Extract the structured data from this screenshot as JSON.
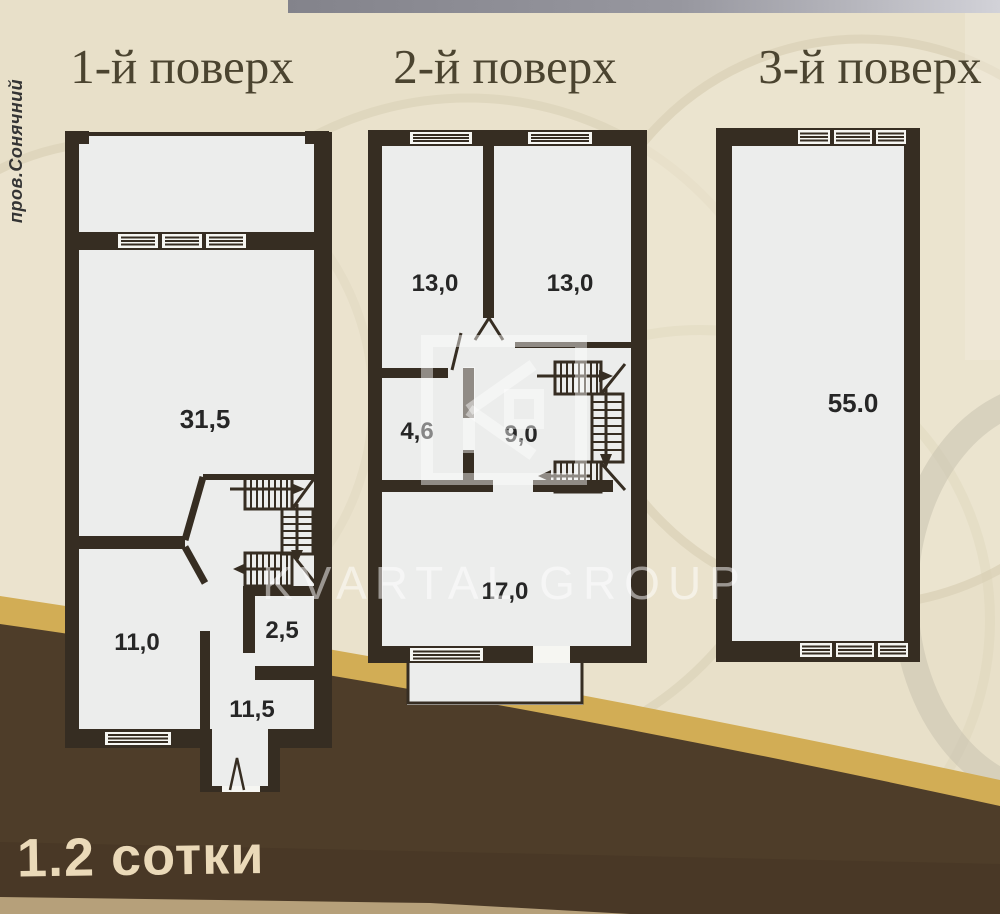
{
  "street_label": "пров.Сонячний",
  "floors": [
    {
      "title": "1-й поверх",
      "rooms": [
        {
          "area": "31,5"
        },
        {
          "area": "11,0"
        },
        {
          "area": "2,5"
        },
        {
          "area": "11,5"
        }
      ]
    },
    {
      "title": "2-й поверх",
      "rooms": [
        {
          "area": "13,0"
        },
        {
          "area": "13,0"
        },
        {
          "area": "4,6"
        },
        {
          "area": "9,0"
        },
        {
          "area": "17,0"
        }
      ]
    },
    {
      "title": "3-й поверх",
      "rooms": [
        {
          "area": "55.0"
        }
      ]
    }
  ],
  "watermark": {
    "text": "KVARTAL GROUP"
  },
  "footer": {
    "dash": "-",
    "area_text": "1.2 сотки"
  },
  "colors": {
    "background": "#e8e0c9",
    "wall": "#362d22",
    "floor_fill": "#ecedec",
    "title_text": "#4b4430",
    "wave_brown": "#4e3d29",
    "gold_band": "#d2ad55",
    "footer_text": "#ead9b8",
    "watermark": "rgba(255,255,255,0.45)",
    "top_strip_gray": "#97979f"
  }
}
